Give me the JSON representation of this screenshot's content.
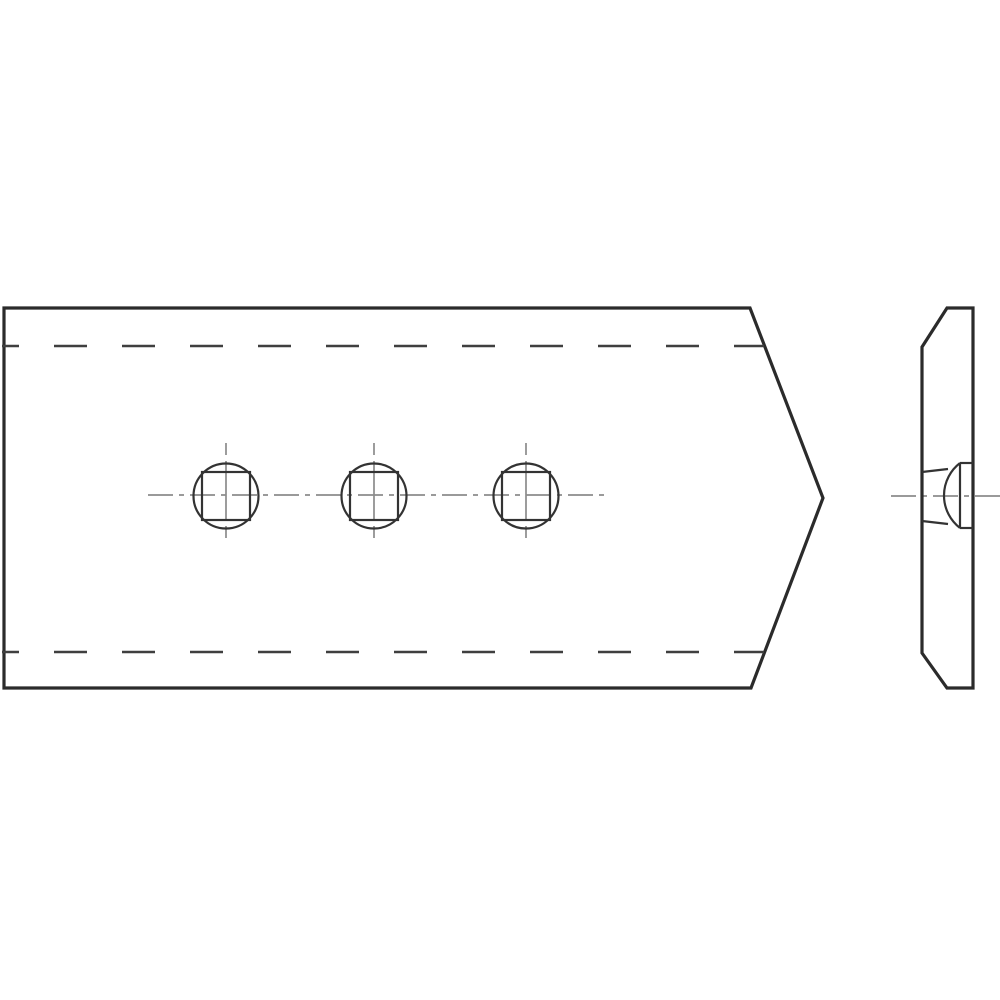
{
  "canvas": {
    "width": 1000,
    "height": 1000,
    "background": "#ffffff"
  },
  "styles": {
    "outline": {
      "color": "#2b2b2b",
      "width": 3.2
    },
    "feature": {
      "color": "#333333",
      "width": 2.2
    },
    "hidden": {
      "color": "#3f3f3f",
      "width": 2.4,
      "dash": "33 35",
      "offset": 16
    },
    "center": {
      "color": "#8c8c8c",
      "width": 1.7,
      "dash": "25 6 5 6"
    },
    "vertical_center_dash": "12 6 59 6 12"
  },
  "front_view": {
    "outline_points": "4,308 750,308 823,498 751,688 4,688",
    "hidden_lines": [
      {
        "x1": 2,
        "y1": 346,
        "x2": 764,
        "y2": 346
      },
      {
        "x1": 2,
        "y1": 652,
        "x2": 764,
        "y2": 652
      }
    ],
    "center_line": {
      "x1": 148,
      "y1": 495,
      "x2": 604,
      "y2": 495
    },
    "holes": {
      "centers_x": [
        226,
        374,
        526
      ],
      "center_y": 496,
      "circle_radius": 32.5,
      "square_size": 48,
      "vline_above": 53,
      "vline_below": 42
    }
  },
  "side_view": {
    "outline_points": "947,308 973,308 973,688 947,688 922,653 922,347",
    "neck": {
      "x": 960,
      "right": 973,
      "top": 463,
      "bottom": 528
    },
    "dome_arc": {
      "from_x": 960,
      "from_y": 463,
      "to_x": 960,
      "to_y": 528,
      "radius": 41
    },
    "countersink_lines": [
      {
        "x1": 922,
        "y1": 472,
        "x2": 948,
        "y2": 469
      },
      {
        "x1": 922,
        "y1": 521,
        "x2": 948,
        "y2": 524
      }
    ],
    "center_line": {
      "x1": 891,
      "y1": 496,
      "x2": 1000,
      "y2": 496
    }
  }
}
